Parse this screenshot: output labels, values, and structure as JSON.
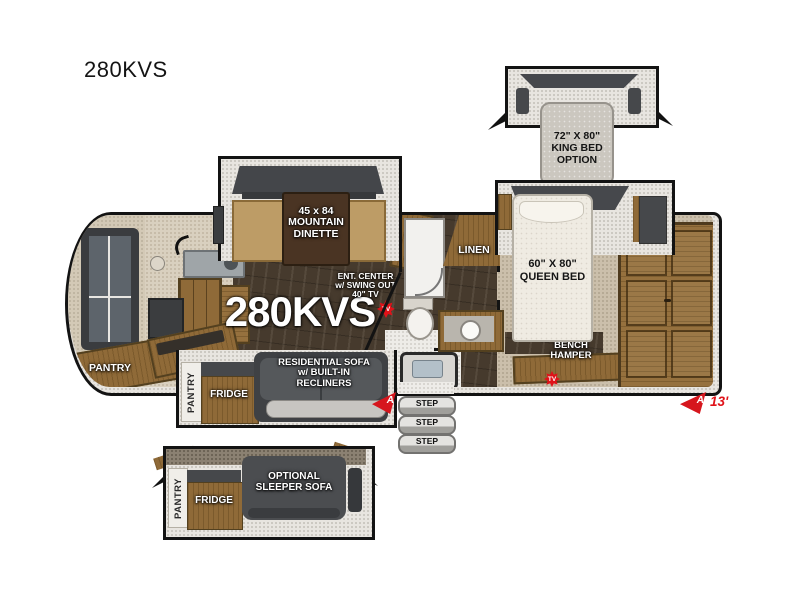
{
  "page": {
    "title": "280KVS"
  },
  "floorplan": {
    "model_label": "280KVS",
    "slides": {
      "king_bed_option": {
        "lines": [
          "72\" X 80\"",
          "KING BED",
          "OPTION"
        ]
      },
      "dinette": {
        "lines": [
          "45 x 84",
          "MOUNTAIN",
          "DINETTE"
        ]
      },
      "galley": {
        "pantry": "PANTRY",
        "fridge": "FRIDGE"
      },
      "sleeper_option": {
        "sofa_lines": [
          "OPTIONAL",
          "SLEEPER SOFA"
        ],
        "pantry": "PANTRY",
        "fridge": "FRIDGE"
      }
    },
    "rooms": {
      "ent_center_lines": [
        "ENT. CENTER",
        "w/ SWING OUT",
        "40\" TV"
      ],
      "queen_bed_lines": [
        "60\" X 80\"",
        "QUEEN BED"
      ],
      "bench_hamper_lines": [
        "BENCH",
        "HAMPER"
      ],
      "sofa_lines": [
        "RESIDENTIAL SOFA",
        "w/ BUILT-IN",
        "RECLINERS"
      ],
      "linen": "LINEN",
      "pantry": "PANTRY"
    },
    "markers": {
      "tv": "TV",
      "awning": "A",
      "awning_length": "13'",
      "step": "STEP"
    },
    "colors": {
      "accent_red": "#e01219",
      "wall": "#131313",
      "wood": "#8f6a38",
      "furniture_gray": "#46484b"
    }
  }
}
